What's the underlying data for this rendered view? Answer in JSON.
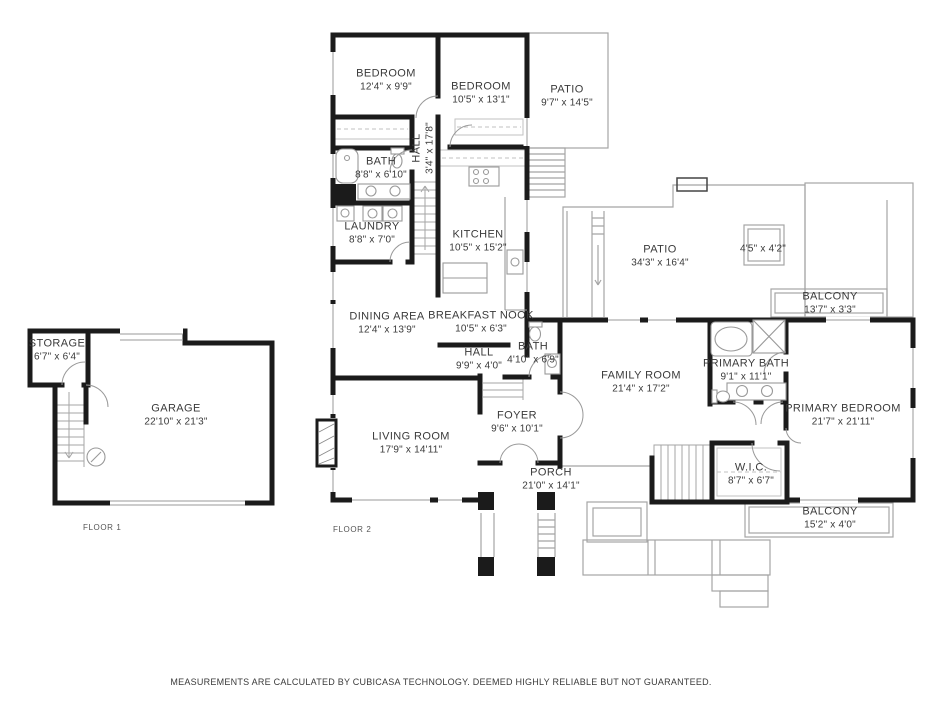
{
  "meta": {
    "footer": "MEASUREMENTS ARE CALCULATED BY CUBICASA TECHNOLOGY. DEEMED HIGHLY RELIABLE BUT NOT GUARANTEED."
  },
  "colors": {
    "wall": "#1b1b1b",
    "thin_line": "#a5a5a5",
    "fixture_line": "#999999",
    "text": "#3a3a3a",
    "background": "#ffffff"
  },
  "floor1": {
    "label": "FLOOR 1",
    "rooms": {
      "storage": {
        "name": "STORAGE",
        "dims": "6'7\" x 6'4\""
      },
      "garage": {
        "name": "GARAGE",
        "dims": "22'10\" x 21'3\""
      }
    }
  },
  "floor2": {
    "label": "FLOOR 2",
    "rooms": {
      "bedroom1": {
        "name": "BEDROOM",
        "dims": "12'4\" x 9'9\""
      },
      "bedroom2": {
        "name": "BEDROOM",
        "dims": "10'5\" x 13'1\""
      },
      "patio_top": {
        "name": "PATIO",
        "dims": "9'7\" x 14'5\""
      },
      "bath1": {
        "name": "BATH",
        "dims": "8'8\" x 6'10\""
      },
      "hall_vertical": {
        "name": "HALL",
        "dims": "3'4\" x 17'8\""
      },
      "laundry": {
        "name": "LAUNDRY",
        "dims": "8'8\" x 7'0\""
      },
      "kitchen": {
        "name": "KITCHEN",
        "dims": "10'5\" x 15'2\""
      },
      "patio_main": {
        "name": "PATIO",
        "dims": "34'3\" x 16'4\""
      },
      "skylight": {
        "dims": "4'5\" x 4'2\""
      },
      "balcony_upper": {
        "name": "BALCONY",
        "dims": "13'7\" x 3'3\""
      },
      "dining": {
        "name": "DINING AREA",
        "dims": "12'4\" x 13'9\""
      },
      "breakfast_nook": {
        "name": "BREAKFAST NOOK",
        "dims": "10'5\" x 6'3\""
      },
      "hall_main": {
        "name": "HALL",
        "dims": "9'9\" x 4'0\""
      },
      "bath2": {
        "name": "BATH",
        "dims": "4'10\" x 6'9\""
      },
      "family": {
        "name": "FAMILY ROOM",
        "dims": "21'4\" x 17'2\""
      },
      "primary_bath": {
        "name": "PRIMARY BATH",
        "dims": "9'1\" x 11'1\""
      },
      "primary_bedroom": {
        "name": "PRIMARY BEDROOM",
        "dims": "21'7\" x 21'11\""
      },
      "foyer": {
        "name": "FOYER",
        "dims": "9'6\" x 10'1\""
      },
      "living": {
        "name": "LIVING ROOM",
        "dims": "17'9\" x 14'11\""
      },
      "porch": {
        "name": "PORCH",
        "dims": "21'0\" x 14'1\""
      },
      "wic": {
        "name": "W.I.C.",
        "dims": "8'7\" x 6'7\""
      },
      "balcony_lower": {
        "name": "BALCONY",
        "dims": "15'2\" x 4'0\""
      }
    }
  }
}
